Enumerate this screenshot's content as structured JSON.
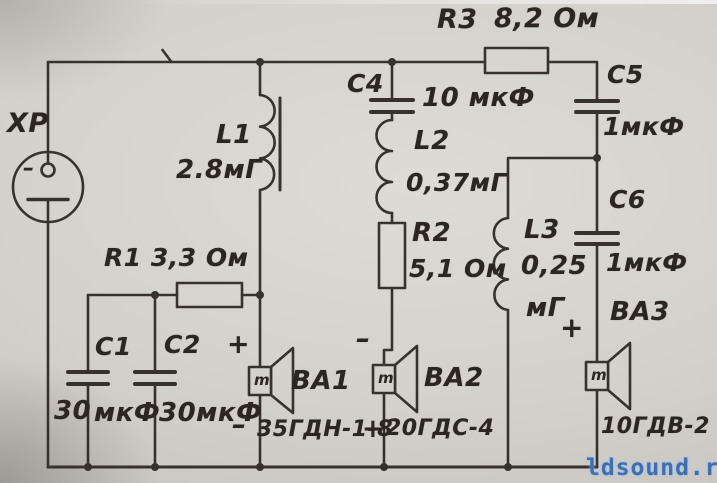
{
  "colors": {
    "paper": "#d5d2cd",
    "ink": "#2b2622",
    "watermark": "#3e6fb0"
  },
  "schematic": {
    "connector": {
      "ref": "ХР",
      "pin_minus": "–"
    },
    "r1": {
      "label": "R1 3,3 Ом"
    },
    "r2": {
      "ref": "R2",
      "value": "5,1 Ом"
    },
    "r3": {
      "ref": "R3",
      "value": "8,2 Ом"
    },
    "c1": {
      "ref": "С1",
      "value_num": "30",
      "value_unit": "мкФ"
    },
    "c2": {
      "ref": "С2",
      "value": "30мкФ"
    },
    "c4": {
      "ref": "С4",
      "value": "10 мкФ"
    },
    "c5": {
      "ref": "С5",
      "value": "1мкФ"
    },
    "c6": {
      "ref": "С6",
      "value": "1мкФ"
    },
    "l1": {
      "ref": "L1",
      "value": "2.8мГ"
    },
    "l2": {
      "ref": "L2",
      "value": "0,37мГ"
    },
    "l3": {
      "ref": "L3",
      "value": "0,25",
      "unit": "мГ"
    },
    "ba1": {
      "ref": "ВА1",
      "model": "35ГДН-1-8",
      "plus": "+",
      "minus": "–",
      "coil": "m"
    },
    "ba2": {
      "ref": "ВА2",
      "model": "20ГДС-4",
      "plus": "+",
      "minus": "–",
      "coil": "m"
    },
    "ba3": {
      "ref": "ВА3",
      "model": "10ГДВ-2",
      "plus": "+",
      "coil": "m"
    }
  },
  "watermark": {
    "text": "ldsound.ru"
  }
}
